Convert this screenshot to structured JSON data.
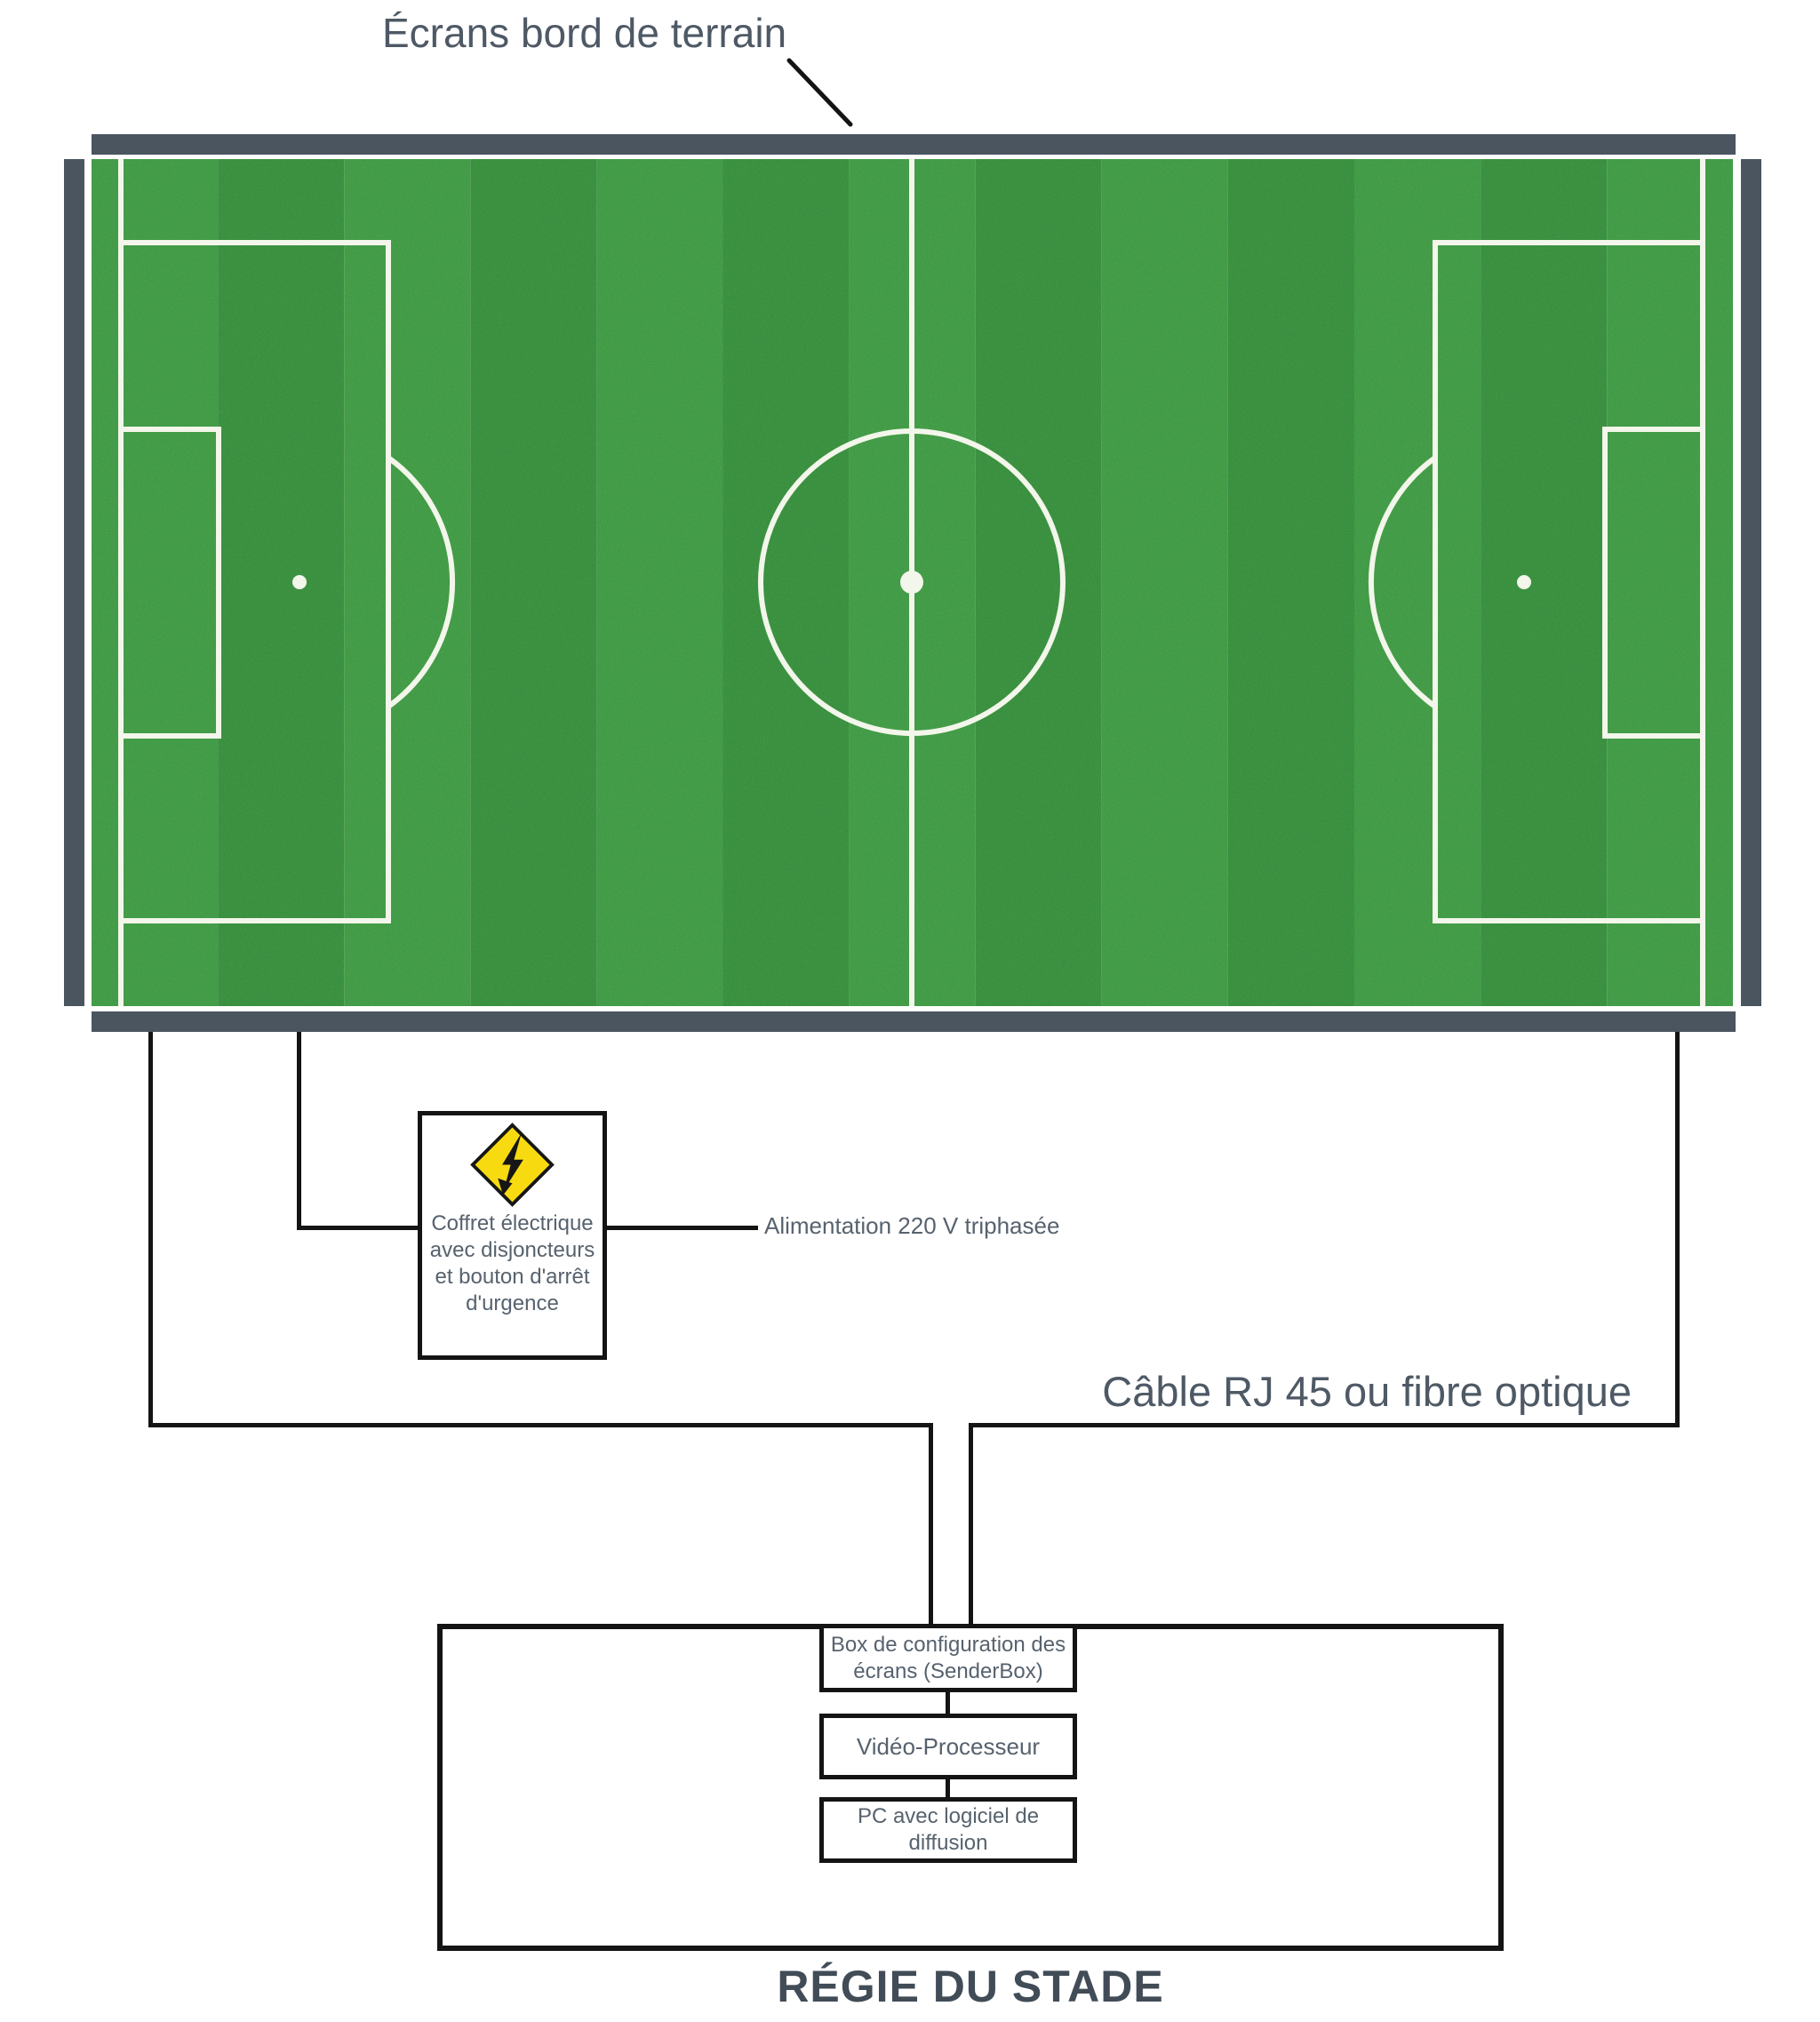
{
  "title": {
    "label": "Écrans bord de terrain"
  },
  "field": {
    "kind": "football-pitch-top-view"
  },
  "electrical_box": {
    "icon": "high-voltage-warning-icon",
    "lines": [
      "Coffret électrique",
      "avec disjoncteurs",
      "et bouton d'arrêt",
      "d'urgence"
    ]
  },
  "labels": {
    "alimentation": "Alimentation 220 V triphasée",
    "cable": "Câble RJ 45 ou fibre optique"
  },
  "regie": {
    "title": "RÉGIE DU STADE",
    "senderbox": {
      "lines": [
        "Box de configuration des",
        "écrans (SenderBox)"
      ]
    },
    "video_processor": {
      "label": "Vidéo-Processeur"
    },
    "pc": {
      "lines": [
        "PC avec logiciel de",
        "diffusion"
      ]
    }
  },
  "colors": {
    "screen_bar": "#4a5560",
    "wire": "#141414",
    "label_text": "#57626e",
    "title_text": "#4e5965",
    "footer_text": "#414c57",
    "grass_light": "#3c9c41",
    "grass_dark": "#339039",
    "pitch_line": "#f3f6ea",
    "warning_yellow": "#f8da10"
  }
}
